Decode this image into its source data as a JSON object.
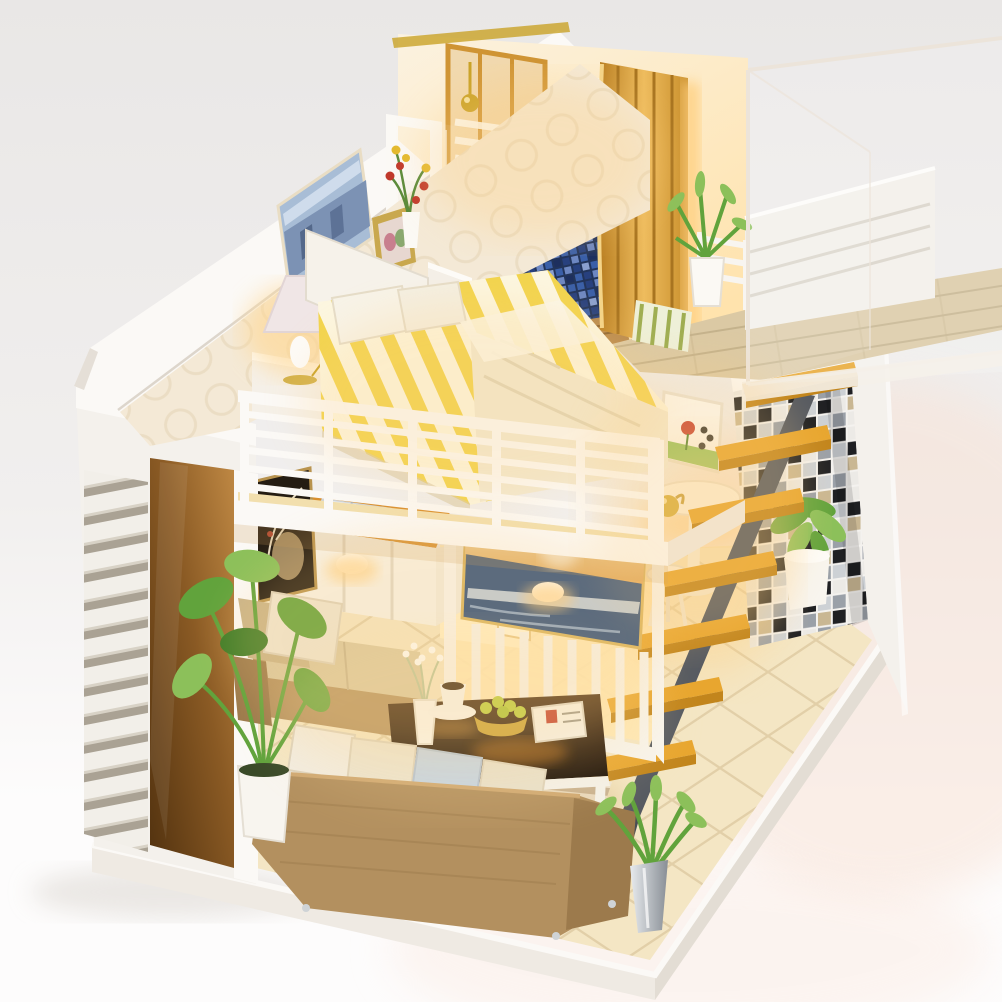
{
  "image": {
    "kind": "product-photograph",
    "subject": "miniature DIY dollhouse — two-storey loft apartment with warm LED lighting",
    "backdrop": "plain studio seamless backdrop"
  },
  "palette": {
    "bg_top": "#e9e7e6",
    "bg_mid": "#f1efee",
    "bg_bottom": "#fdfcfc",
    "glow_pink": "#f8e3d7",
    "platform_white": "#efeae3",
    "platform_side": "#e3ddd4",
    "wall_white": "#f4f1ec",
    "wall_bright": "#fbf9f6",
    "wall_shadow": "#ddd6cc",
    "wallpaper": "#f4e9d6",
    "wallpaper_ring": "#e8d9bc",
    "cream_wall": "#fbf2e0",
    "warm_wall": "#ffe3ad",
    "amber_dark": "#52320f",
    "amber_mid": "#8a5a24",
    "amber_light": "#c08944",
    "gold_wood": "#cf9434",
    "gold_wood_light": "#eebc5e",
    "gold_metal": "#c9a227",
    "stair_orange": "#e8a62f",
    "stair_edge": "#c2851c",
    "stringer": "#565a61",
    "mosaic_dark": "#1f2023",
    "mosaic_gray": "#9aa0a8",
    "mosaic_light": "#eceae6",
    "mosaic_tan": "#c9b793",
    "mosaic_mid": "#cdd1d5",
    "tile_blue": "#3a5fa8",
    "tile_blue_dark": "#27407e",
    "tile_blue_light": "#6d87c2",
    "floor_tile": "#f4e6c4",
    "floor_grout": "#d9c49a",
    "floor_lit": "#fff3d8",
    "wood_floor": "#dbc9a4",
    "wood_line": "#c4b28c",
    "bed_yellow": "#f2d44e",
    "bed_white": "#fcf6e0",
    "blanket": "#f2e9d2",
    "sofa_brown": "#b3905f",
    "sofa_dark": "#9c7a4c",
    "cushion_weave": "#d9c8a0",
    "pillow_cream": "#ece4d0",
    "pillow_blue": "#c5d4e4",
    "rug_a": "#c9b7a0",
    "rug_b": "#f3ecdf",
    "table_top": "#2e1c0c",
    "table_glow": "#b56a14",
    "plant_green": "#61a33c",
    "plant_light": "#8cc05a",
    "plant_dark": "#3f7d28",
    "ocean": "#2e4f7d",
    "ocean_sky": "#f2c478",
    "city_pic": "#a8bdd6",
    "silver": "#cfd3d6",
    "warm_glow": "#ffcf7e",
    "lamp_glow": "#ffd894",
    "orange_counter": "#d98f2e",
    "white_furniture": "#f7f3ea"
  },
  "scene": {
    "upper_floor": [
      {
        "id": "bedroom",
        "label": "loft bedroom with yellow striped double bed"
      },
      {
        "id": "wall-art-city",
        "label": "blue city-scene picture on circle-pattern wallpaper"
      },
      {
        "id": "photo-frame",
        "label": "gold photo frame on headboard shelf"
      },
      {
        "id": "table-lamp",
        "label": "lit bedside lamp on white nightstand"
      },
      {
        "id": "bathroom",
        "label": "bathroom with shower, toilet, basin, mirror"
      },
      {
        "id": "blue-tile-floor",
        "label": "blue mosaic bathroom floor"
      },
      {
        "id": "timber-screens",
        "label": "golden timber slat partitions"
      },
      {
        "id": "loft-landing",
        "label": "wood-plank landing with potted plant"
      },
      {
        "id": "balcony-railing",
        "label": "white slatted balcony railing"
      }
    ],
    "lower_floor": [
      {
        "id": "living-room",
        "label": "living room with burlap sofas"
      },
      {
        "id": "tv-seascape",
        "label": "ocean sunset picture mounted on white baluster divider"
      },
      {
        "id": "kitchen-island",
        "label": "white island with orange top and steel sink"
      },
      {
        "id": "coffee-table",
        "label": "dark glass coffee table with cup, vase, fruit bowl, book"
      },
      {
        "id": "area-rug",
        "label": "striped rug"
      },
      {
        "id": "round-side-table",
        "label": "white pedestal table with gold teapot and stool"
      },
      {
        "id": "artwork-dark",
        "label": "dark gold floral artwork"
      },
      {
        "id": "artwork-tulip",
        "label": "small tulip artwork beside stairs"
      },
      {
        "id": "plants",
        "label": "green potted plants"
      }
    ],
    "structure": [
      {
        "id": "staircase",
        "label": "floating staircase",
        "treads": 7
      },
      {
        "id": "mosaic-wall",
        "label": "black/white/grey mosaic feature wall"
      },
      {
        "id": "louver-wall",
        "label": "white louvered exterior wall with amber window"
      },
      {
        "id": "display-case",
        "label": "clear acrylic dust cover, top right"
      },
      {
        "id": "base-platform",
        "label": "white display base with cream diagonal floor tiles"
      }
    ],
    "lighting": {
      "style": "warm yellow LED glow from interior lamps"
    }
  }
}
